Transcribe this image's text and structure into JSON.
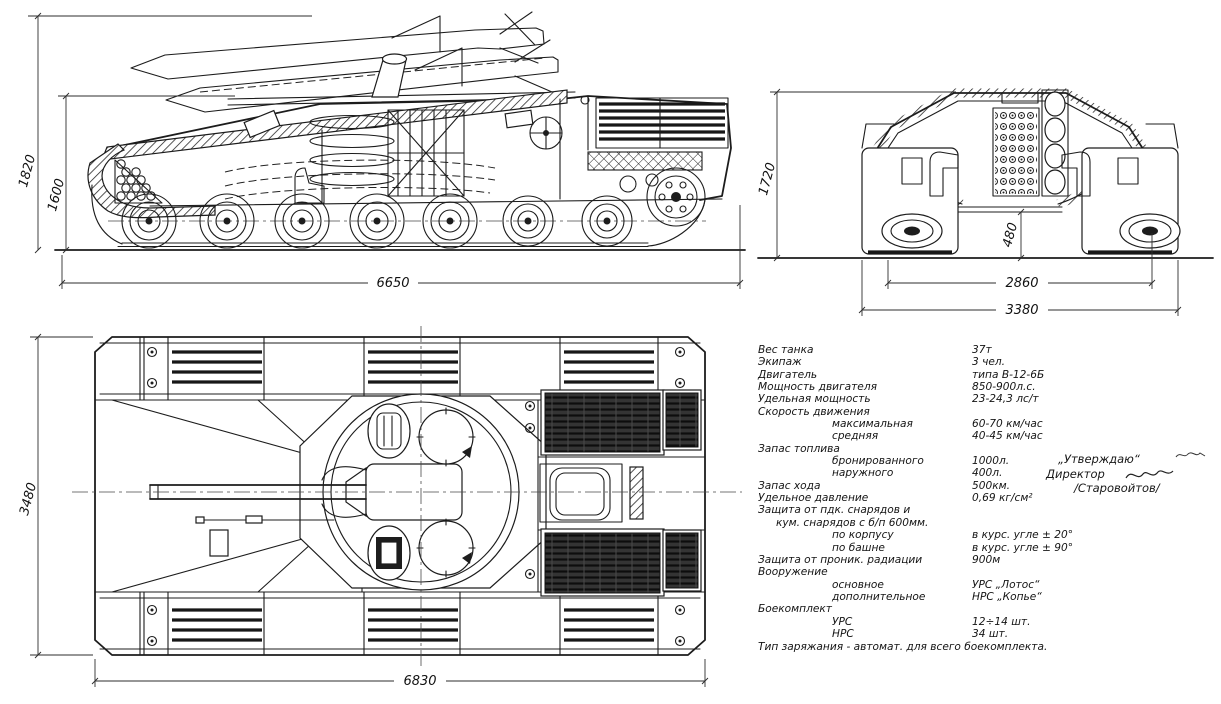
{
  "palette": {
    "paper": "#ffffff",
    "ink": "#1c1c1c",
    "dim_ink": "#2e2e2e"
  },
  "dims": {
    "side": {
      "height_overall": "1820",
      "height_hull": "1600",
      "length": "6650"
    },
    "front": {
      "height": "1720",
      "clearance": "480",
      "track_span": "2860",
      "width": "3380"
    },
    "top": {
      "width": "3480",
      "length": "6830"
    }
  },
  "specs": {
    "rows": [
      {
        "label": "Вес танка",
        "value": "37т",
        "indent": 0
      },
      {
        "label": "Экипаж",
        "value": "3 чел.",
        "indent": 0
      },
      {
        "label": "Двигатель",
        "value": "типа В-12-6Б",
        "indent": 0
      },
      {
        "label": "Мощность двигателя",
        "value": "850-900л.с.",
        "indent": 0
      },
      {
        "label": "Удельная мощность",
        "value": "23-24,3 лс/т",
        "indent": 0
      },
      {
        "label": "Скорость движения",
        "value": "",
        "indent": 0
      },
      {
        "label": "максимальная",
        "value": "60-70 км/час",
        "indent": 1
      },
      {
        "label": "средняя",
        "value": "40-45 км/час",
        "indent": 1
      },
      {
        "label": "Запас топлива",
        "value": "",
        "indent": 0
      },
      {
        "label": "бронированного",
        "value": "1000л.",
        "indent": 1
      },
      {
        "label": "наружного",
        "value": "400л.",
        "indent": 1
      },
      {
        "label": "Запас хода",
        "value": "500км.",
        "indent": 0
      },
      {
        "label": "Удельное давление",
        "value": "0,69 кг/см²",
        "indent": 0
      },
      {
        "label": "Защита от пдк. снарядов и",
        "value": "",
        "indent": 0
      },
      {
        "label": "кум. снарядов с б/п 600мм.",
        "value": "",
        "indent": 2
      },
      {
        "label": "по корпусу",
        "value": "в курс. угле ± 20°",
        "indent": 1
      },
      {
        "label": "по башне",
        "value": "в курс. угле ± 90°",
        "indent": 1
      },
      {
        "label": "Защита от проник. радиации",
        "value": "900м",
        "indent": 0
      },
      {
        "label": "Вооружение",
        "value": "",
        "indent": 0
      },
      {
        "label": "основное",
        "value": "УРС „Лотос“",
        "indent": 1
      },
      {
        "label": "дополнительное",
        "value": "НРС „Копье“",
        "indent": 1
      },
      {
        "label": "Боекомплект",
        "value": "",
        "indent": 0
      },
      {
        "label": "УРС",
        "value": "12÷14 шт.",
        "indent": 1
      },
      {
        "label": "НРС",
        "value": "34 шт.",
        "indent": 1
      }
    ],
    "footer": "Тип заряжания - автомат. для всего боекомплекта."
  },
  "approval": {
    "stamp": "„Утверждаю“",
    "title": "Директор",
    "name": "/Старовойтов/"
  }
}
